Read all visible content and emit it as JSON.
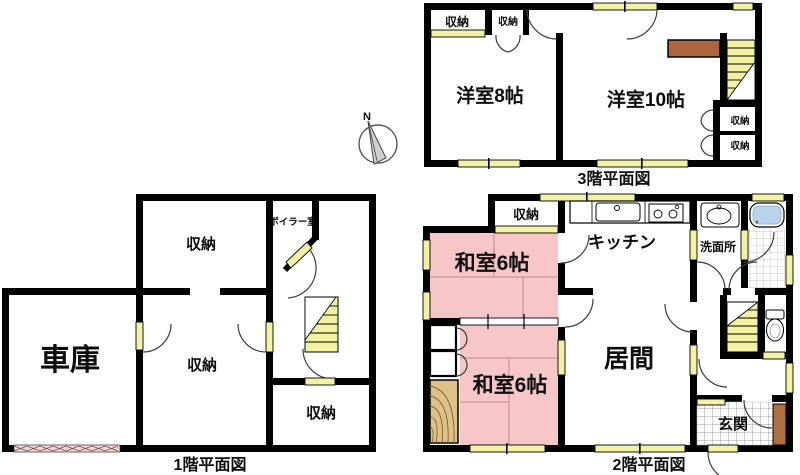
{
  "compass": {
    "label": "N"
  },
  "colors": {
    "wall": "#000000",
    "fixture_yellow": "#f2f2a2",
    "tatami_pink": "#f6c6c8",
    "wood_counter_brown": "#ad6540",
    "entrance_brown": "#b0703e",
    "bath_blue": "#b9d5ec"
  },
  "floor1": {
    "caption": "1階平面図",
    "rooms": {
      "garage": "車庫",
      "storage_top": "収納",
      "boiler": "ボイラー室",
      "storage_middle": "収納",
      "storage_back": "収納"
    }
  },
  "floor2": {
    "caption": "2階平面図",
    "rooms": {
      "storage": "収納",
      "japanese_room_upper": "和室6帖",
      "japanese_room_lower": "和室6帖",
      "kitchen": "キッチン",
      "living": "居間",
      "washroom": "洗面所",
      "entrance": "玄関"
    }
  },
  "floor3": {
    "caption": "3階平面図",
    "rooms": {
      "storage_left_1": "収納",
      "storage_left_2": "収納",
      "western_room_8": "洋室8帖",
      "western_room_10": "洋室10帖",
      "storage_right_1": "収納",
      "storage_right_2": "収納"
    }
  }
}
